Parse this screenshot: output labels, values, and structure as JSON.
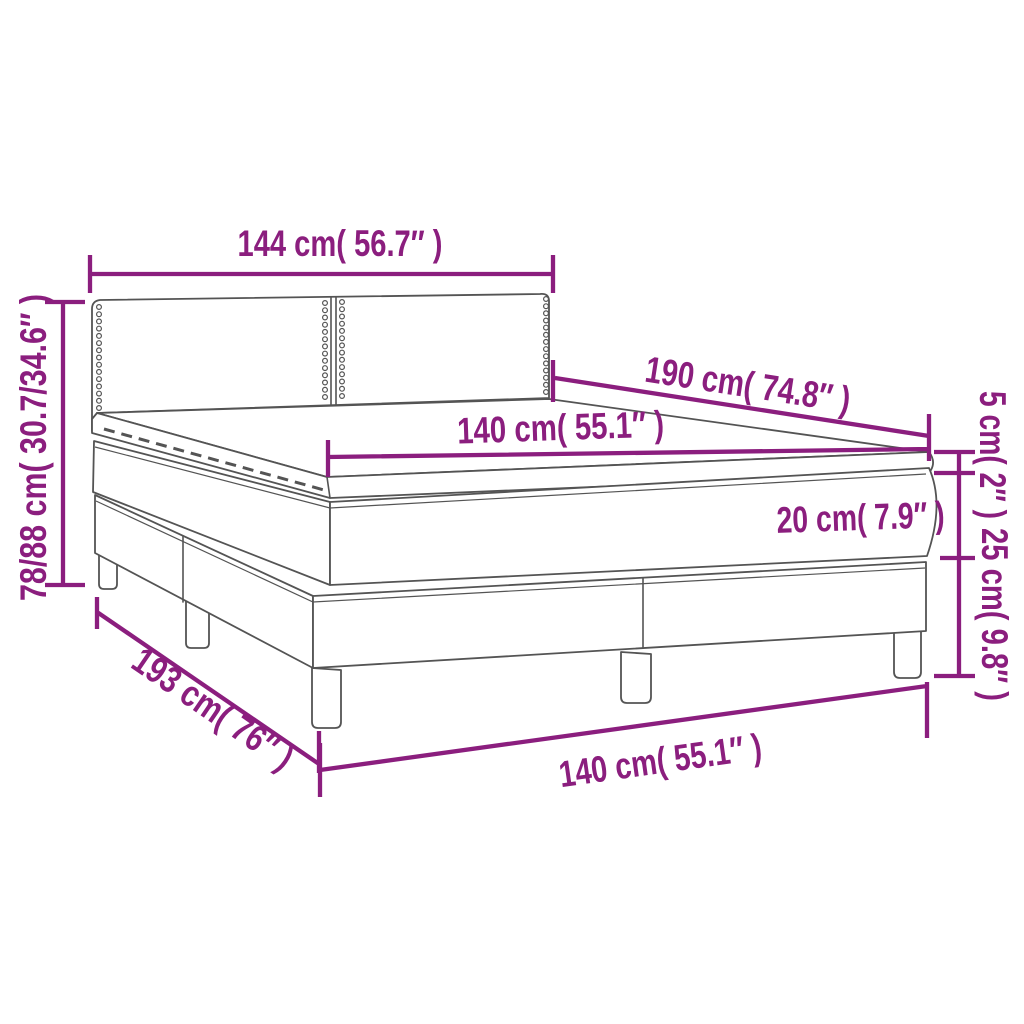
{
  "figure": {
    "type": "product-dimension-diagram",
    "subject": "box spring bed with mattress and topper"
  },
  "colors": {
    "accent": "#8B1E7E",
    "line": "#545454",
    "background": "#ffffff"
  },
  "dims": {
    "headboard_width": "144 cm( 56.7″ )",
    "total_height": "78/88 cm( 30.7/34.6″ )",
    "bed_length_top": "190 cm( 74.8″ )",
    "mattress_width_top": "140 cm( 55.1″ )",
    "topper_height": "5 cm( 2″ )",
    "mattress_height": "20 cm( 7.9″ )",
    "base_height": "25 cm( 9.8″ )",
    "bed_length_bottom": "193 cm( 76″ )",
    "bed_width_bottom": "140 cm( 55.1″ )"
  }
}
